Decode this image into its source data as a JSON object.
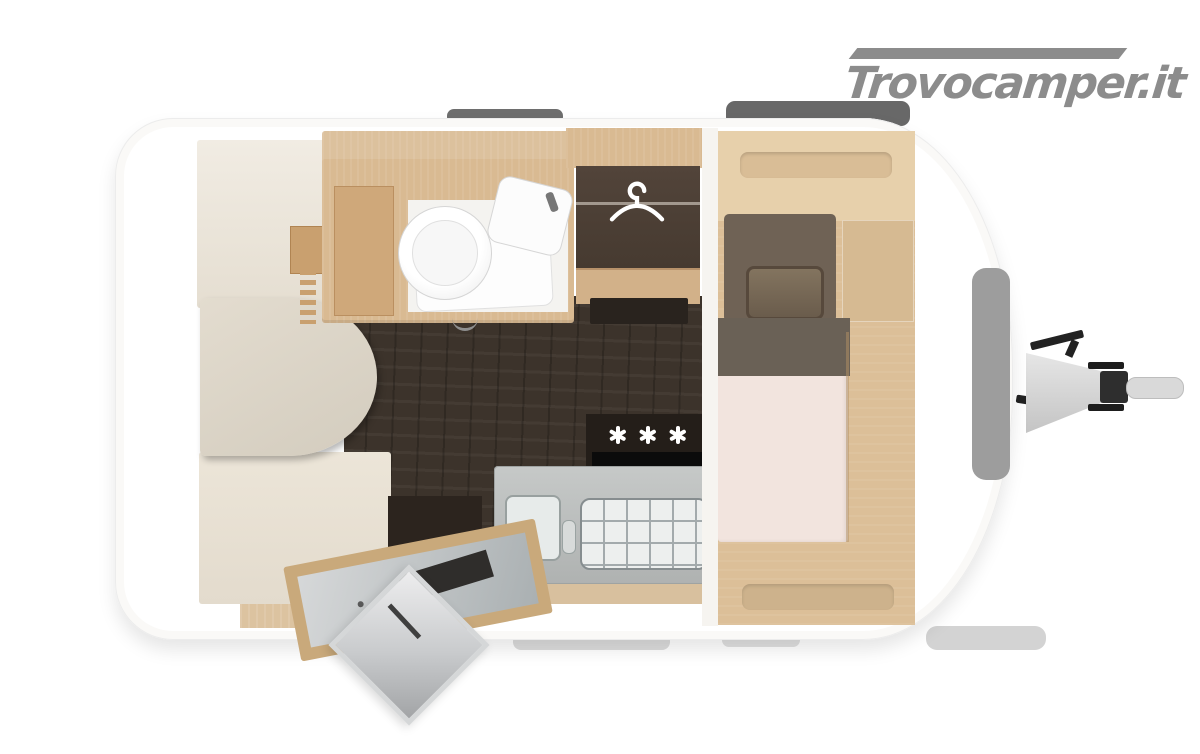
{
  "watermark": {
    "text": "Trovocamper.it"
  },
  "colors": {
    "logo-gray": "#8c8c8c",
    "wood": "#d9ba92",
    "floor-dark": "#3c332b",
    "wardrobe-dark": "#463a30",
    "pillow-brown": "#6f6255",
    "blanket-brown": "#6a6156",
    "mattress": "#f2e4de",
    "kitchen-gray": "#afb2b1",
    "window-gray": "#9d9d9d",
    "roof-window-gray": "#6e6e6e",
    "marker-white": "#ffffff"
  },
  "icons": {
    "wardrobe": "hanger-icon",
    "kitchen_marker": "three-asterisks-gas-burners-icon",
    "bathroom": "toilet-and-washbasin",
    "exterior": "tow-hitch-and-open-entry-door"
  }
}
